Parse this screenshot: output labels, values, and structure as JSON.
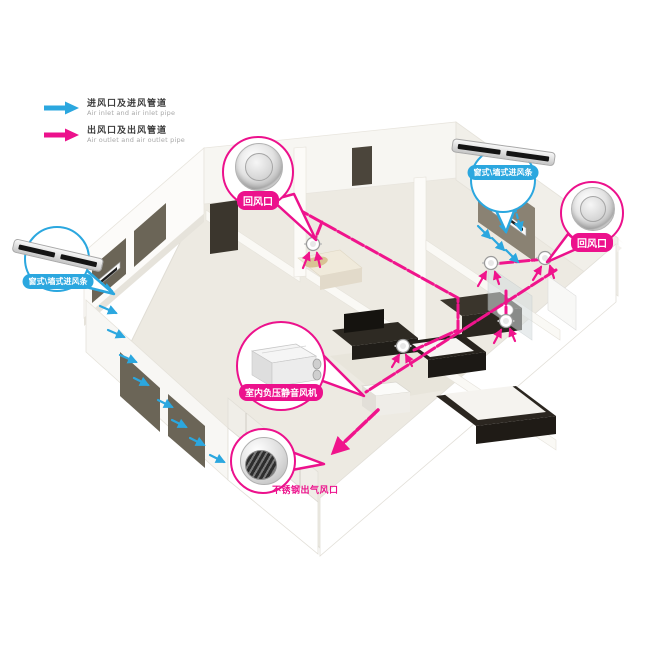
{
  "legend": {
    "items": [
      {
        "id": "inlet",
        "zh": "进风口及进风管道",
        "en": "Air inlet and air inlet pipe",
        "color": "#2ba7df",
        "icon": "blue-flow-arrow-icon"
      },
      {
        "id": "outlet",
        "zh": "出风口及出风管道",
        "en": "Air outlet and air outlet pipe",
        "color": "#ec118c",
        "icon": "magenta-flow-arrow-icon"
      }
    ]
  },
  "callouts": {
    "return_air_top": {
      "label": "回风口",
      "type": "outlet",
      "device": "round-ceiling-diffuser"
    },
    "inlet_strip_right": {
      "label": "窗式\\墙式进风条",
      "type": "inlet",
      "device": "window-wall-inlet-strip"
    },
    "return_air_right": {
      "label": "回风口",
      "type": "outlet",
      "device": "round-ceiling-diffuser"
    },
    "inlet_strip_left": {
      "label": "窗式\\墙式进风条",
      "type": "inlet",
      "device": "window-wall-inlet-strip"
    },
    "silent_fan": {
      "label": "室内负压静音风机",
      "type": "outlet",
      "device": "negative-pressure-fan-box"
    },
    "steel_outlet": {
      "label": "不锈钢出气风口",
      "type": "outlet",
      "device": "stainless-steel-vent"
    }
  },
  "colors": {
    "inlet_blue": "#2ba7df",
    "outlet_magenta": "#ec118c",
    "wall_white": "#faf9f6",
    "floor_beige": "#edeae2"
  }
}
